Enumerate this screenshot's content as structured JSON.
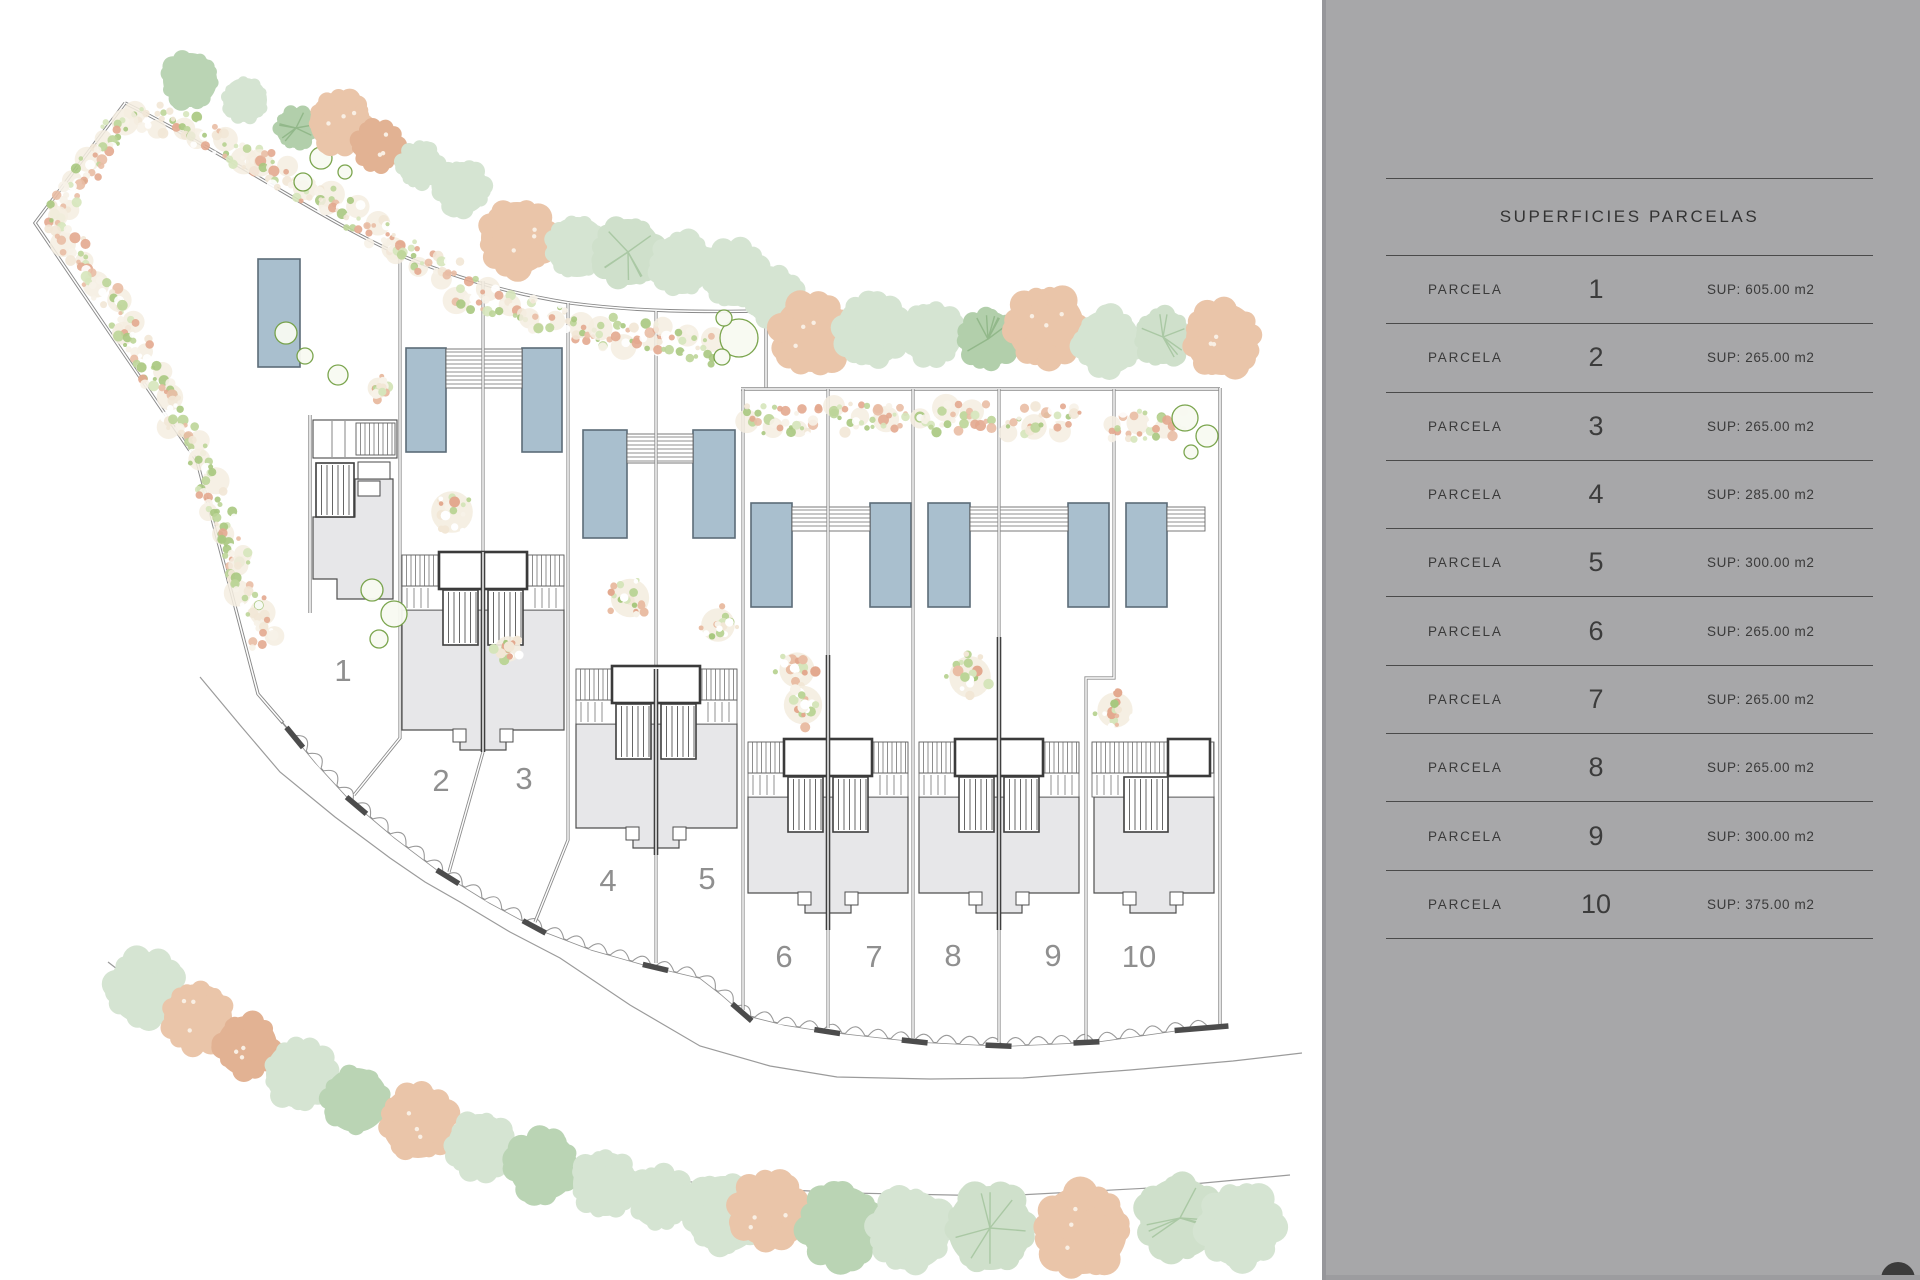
{
  "plan": {
    "parcel_labels": [
      "1",
      "2",
      "3",
      "4",
      "5",
      "6",
      "7",
      "8",
      "9",
      "10"
    ]
  },
  "panel": {
    "title": "SUPERFICIES PARCELAS",
    "row_label": "PARCELA",
    "rows": [
      {
        "num": "1",
        "sup": "SUP: 605.00 m2"
      },
      {
        "num": "2",
        "sup": "SUP: 265.00 m2"
      },
      {
        "num": "3",
        "sup": "SUP: 265.00 m2"
      },
      {
        "num": "4",
        "sup": "SUP: 285.00 m2"
      },
      {
        "num": "5",
        "sup": "SUP: 300.00 m2"
      },
      {
        "num": "6",
        "sup": "SUP: 265.00 m2"
      },
      {
        "num": "7",
        "sup": "SUP: 265.00 m2"
      },
      {
        "num": "8",
        "sup": "SUP: 265.00 m2"
      },
      {
        "num": "9",
        "sup": "SUP: 300.00 m2"
      },
      {
        "num": "10",
        "sup": "SUP: 375.00 m2"
      }
    ]
  },
  "colors": {
    "panel_bg": "#a7a7a9",
    "table_line": "#4a4a4a",
    "text_dark": "#3a3a3a",
    "parcel_label_gray": "#8f8f8f",
    "pool_fill": "#a9bfce",
    "pool_stroke": "#5c6c78",
    "house_gray": "#e7e7e9",
    "tree_green_pale": "#d5e4d2",
    "tree_green_medium": "#bad4b4",
    "tree_peach": "#eac5a9",
    "tree_peach_dark": "#e2b293",
    "hedge_salmon": "#e9bda4",
    "hedge_cream": "#f2e7d6",
    "hedge_green": "#bcd598"
  }
}
